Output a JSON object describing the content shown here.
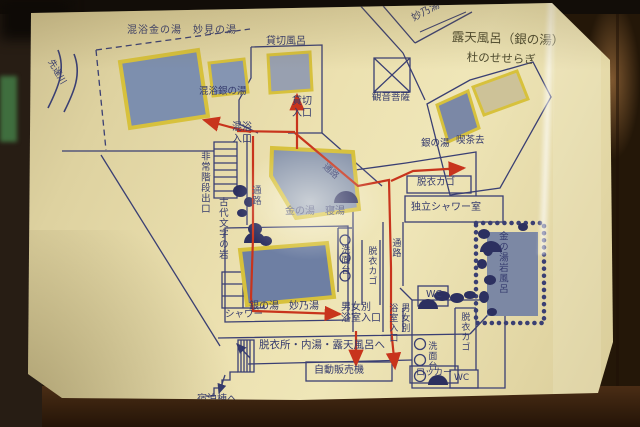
{
  "title": "温泉館内案内図（手書きマップの写真）",
  "colors": {
    "card_paper": "#ece1b0",
    "map_ink_navy": "#343a6d",
    "route_red": "#c8341c",
    "pool_fill_blue": "#7d8fae",
    "pool_border_yellow": "#d7c13c",
    "table_wood_brown": "#7a4e28",
    "handwriting_olive": "#4d4a2f"
  },
  "labels": {
    "open_air_title": "露天風呂（銀の湯）",
    "open_air_subtitle": "杜のせせらぎ",
    "to_taenoyu": "妙乃湯へ",
    "mixed_kin_pool": "混浴金の湯　妙見の湯",
    "mixed_gin_pool": "混浴銀の湯",
    "river": "先達川",
    "private_bath": "貸切風呂",
    "private_entrance": "貸切入口",
    "kannon_statue": "観音菩薩",
    "gin_no_yu": "銀の湯",
    "kissako": "喫茶去",
    "emergency_exit": "非常階段出口",
    "ancient_letters_rock": "古代文字の岩",
    "mixed_entrance": "混浴入口",
    "corridor_a": "通路",
    "corridor_b": "通路",
    "corridor_c": "通路",
    "kin_no_yu_neyu": "金の湯　寝湯",
    "clothes_basket_box": "脱衣カゴ",
    "independent_shower_room": "独立シャワー室",
    "kin_rock_bath": "金の湯岩風呂",
    "washstand_1": "洗面台",
    "clothes_basket_2": "脱衣カゴ",
    "wc_1": "WC",
    "gender_entrance_line1": "男女別",
    "gender_entrance_line2": "浴室入口",
    "gender_entrance_v_col1": "男女別",
    "gender_entrance_v_col2": "浴室入口",
    "gin_no_yu_taenoyu": "銀の湯　妙乃湯",
    "shower": "シャワー",
    "to_dressing_baths": "脱衣所・内湯・露天風呂へ",
    "vending_machine": "自動販売機",
    "locker": "ロッカー",
    "to_lodging": "宿泊棟へ",
    "washstand_2": "洗面台",
    "clothes_basket_3": "脱衣カゴ",
    "wc_2": "WC"
  }
}
